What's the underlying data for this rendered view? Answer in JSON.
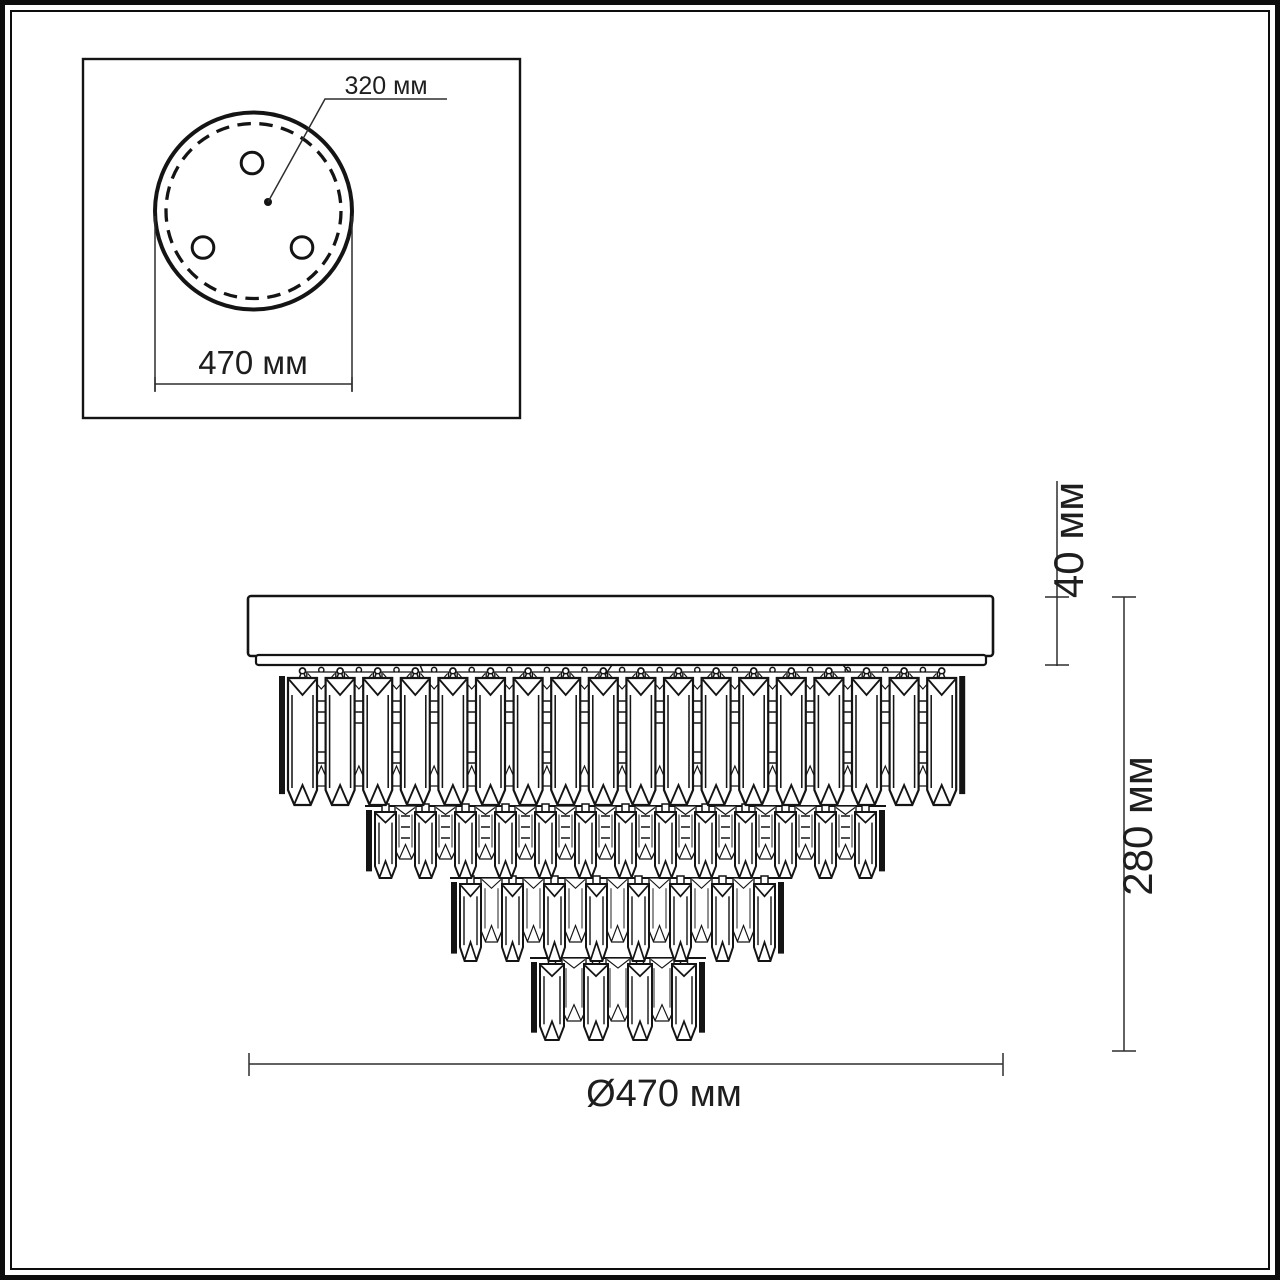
{
  "drawing": {
    "kind": "technical dimension diagram",
    "subject": "tiered crystal ceiling chandelier, side view with mounting plate inset",
    "units": "мм"
  },
  "inset": {
    "center_label": "320 мм",
    "width_label": "470 мм",
    "mount_hole_count": 3
  },
  "main_view": {
    "canopy_height_label": "40 мм",
    "total_height_label": "280 мм",
    "diameter_label": "Ø470 мм",
    "tiers": [
      {
        "name": "tier-1",
        "count": 18,
        "pitch": 37.6,
        "width": 29,
        "x_left": 288,
        "y_top": 678,
        "height": 127,
        "hooks": true,
        "chains": true
      },
      {
        "name": "tier-2",
        "count": 13,
        "pitch": 40,
        "width": 21,
        "x_left": 375,
        "y_top": 812,
        "height": 66,
        "hooks": false,
        "chains": true
      },
      {
        "name": "tier-3",
        "count": 8,
        "pitch": 42,
        "width": 21,
        "x_left": 460,
        "y_top": 884,
        "height": 77,
        "hooks": false,
        "chains": false
      },
      {
        "name": "tier-4",
        "count": 4,
        "pitch": 44,
        "width": 24,
        "x_left": 540,
        "y_top": 964,
        "height": 76,
        "hooks": false,
        "chains": false
      }
    ]
  },
  "colors": {
    "line": "#141414",
    "dimension_line": "#2e2e2e",
    "background": "#ffffff"
  }
}
